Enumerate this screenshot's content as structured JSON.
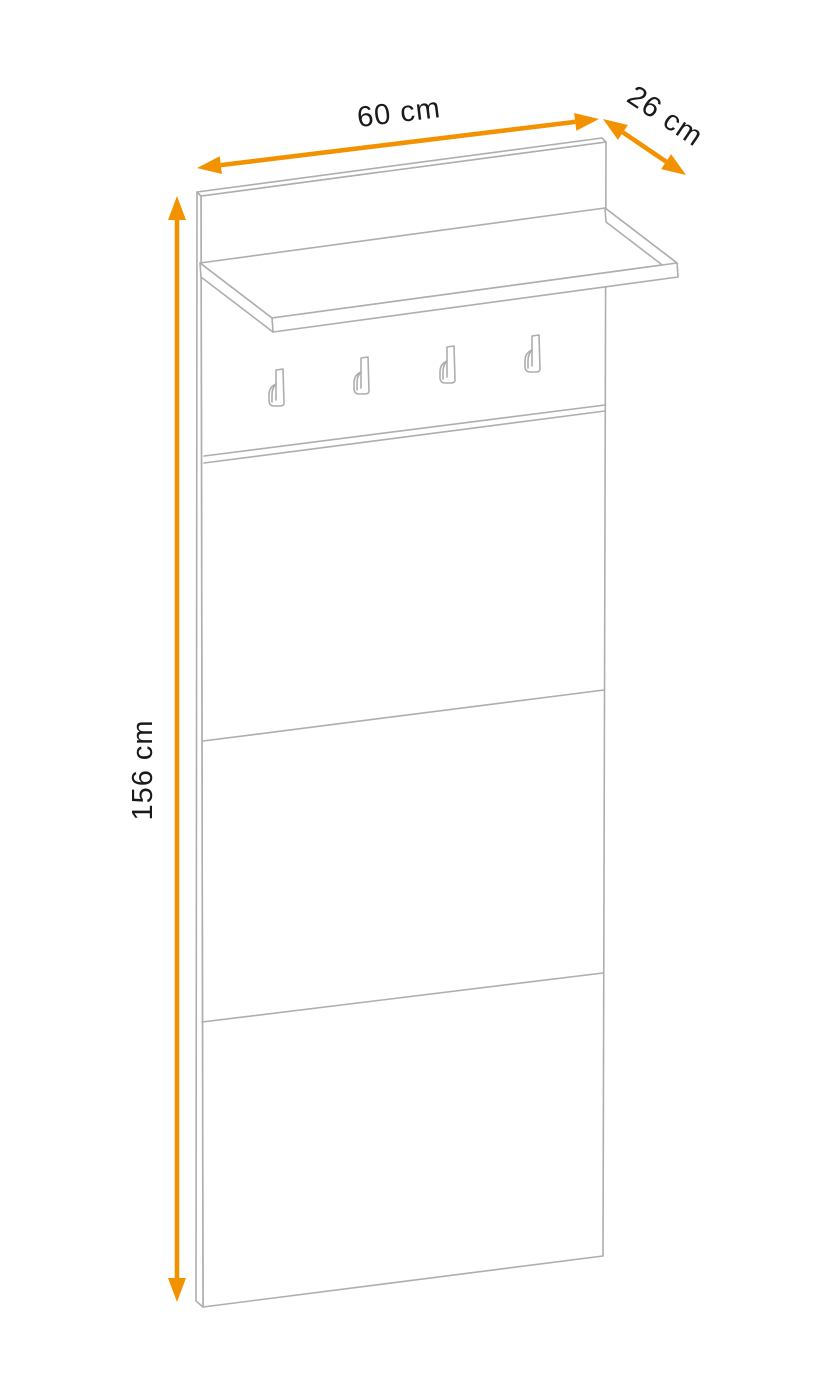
{
  "diagram": {
    "title": "coat-rack-wall-panel-dimension-diagram",
    "hooks_count": 4,
    "dimensions": {
      "width": {
        "label": "60 cm"
      },
      "depth": {
        "label": "26 cm"
      },
      "height": {
        "label": "156 cm"
      }
    },
    "colors": {
      "accent_orange": "#F29200",
      "drawing_line_gray": "#AEAEAE",
      "label_text": "#1A1A1A",
      "background": "#FFFFFF"
    }
  }
}
